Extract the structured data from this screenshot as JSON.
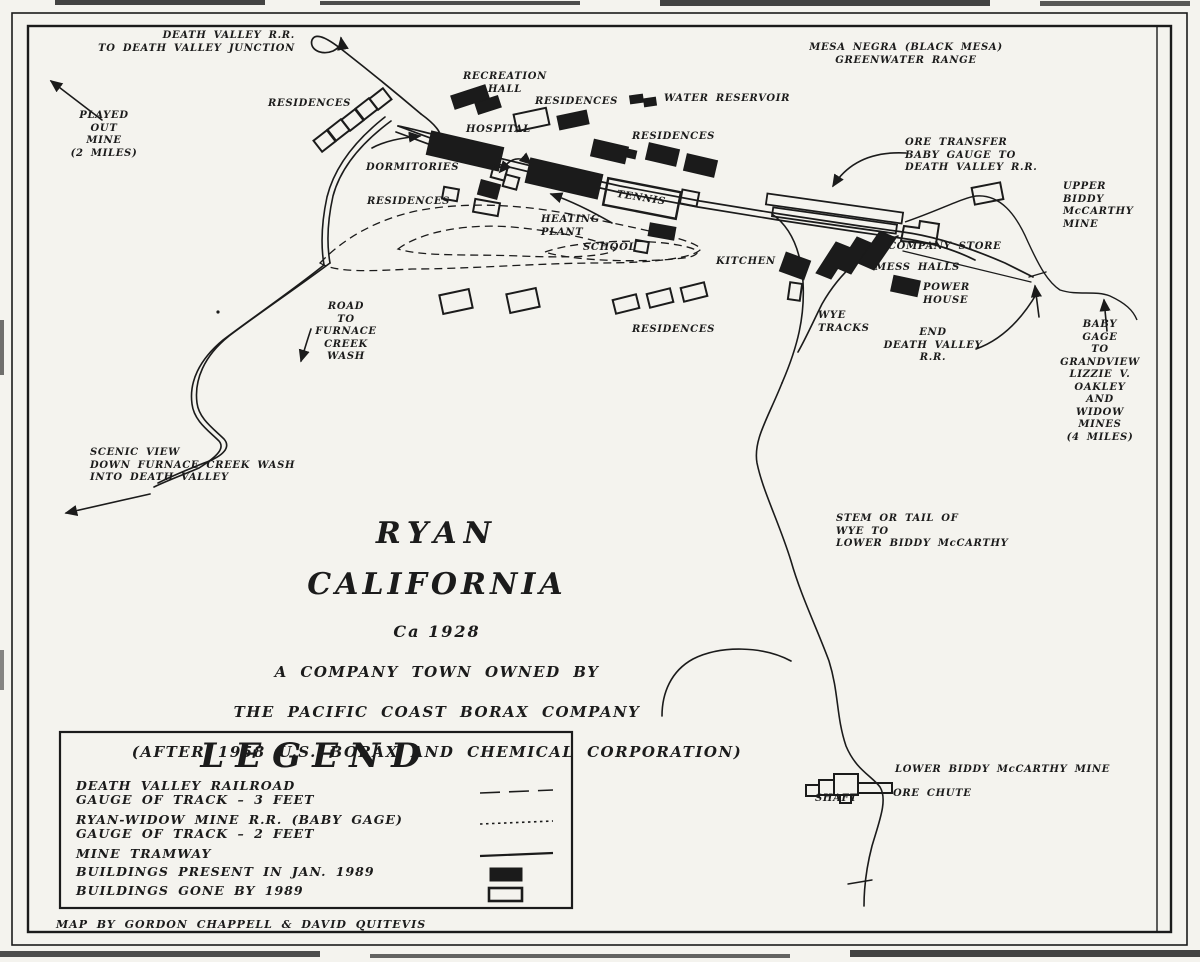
{
  "colors": {
    "paper": "#f4f3ee",
    "ink": "#1b1b1b"
  },
  "title": {
    "l1": "RYAN",
    "l2": "CALIFORNIA",
    "l3": "Ca 1928",
    "l4": "A COMPANY TOWN OWNED BY",
    "l5": "THE PACIFIC COAST BORAX COMPANY",
    "l6": "(AFTER 1958 U.S. BORAX AND CHEMICAL CORPORATION)"
  },
  "labels": {
    "dv_rr_junction": "DEATH VALLEY R.R.\nTO DEATH VALLEY JUNCTION",
    "played_out_mine": "PLAYED\nOUT\nMINE\n(2 MILES)",
    "mesa_negra": "MESA NEGRA (BLACK MESA)\nGREENWATER RANGE",
    "residences_nw": "RESIDENCES",
    "recreation_hall": "RECREATION\nHALL",
    "residences_c1": "RESIDENCES",
    "water_reservoir": "WATER RESERVOIR",
    "hospital": "HOSPITAL",
    "residences_c2": "RESIDENCES",
    "dormitories": "DORMITORIES",
    "ore_transfer": "ORE TRANSFER\nBABY GAUGE TO\nDEATH VALLEY R.R.",
    "upper_biddy": "UPPER\nBIDDY\nMcCARTHY\nMINE",
    "residences_w": "RESIDENCES",
    "heating_plant": "HEATING\nPLANT",
    "tennis": "TENNIS",
    "school": "SCHOOL",
    "company_store": "COMPANY STORE",
    "kitchen": "KITCHEN",
    "mess_halls": "MESS HALLS",
    "power_house": "POWER\nHOUSE",
    "wye_tracks": "WYE\nTRACKS",
    "road_furnace": "ROAD\nTO\nFURNACE\nCREEK\nWASH",
    "residences_s": "RESIDENCES",
    "end_dvrr": "END\nDEATH VALLEY\nR.R.",
    "baby_gage_grandview": "BABY\nGAGE\nTO\nGRANDVIEW\nLIZZIE V. OAKLEY\nAND\nWIDOW\nMINES\n(4 MILES)",
    "scenic_view": "SCENIC VIEW\nDOWN FURNACE CREEK WASH\nINTO DEATH VALLEY",
    "stem_tail": "STEM OR TAIL OF\nWYE TO\nLOWER BIDDY McCARTHY",
    "lower_biddy_mine": "LOWER BIDDY McCARTHY MINE",
    "shaft": "SHAFT",
    "ore_chute": "ORE CHUTE"
  },
  "legend": {
    "title": "LEGEND",
    "items": [
      {
        "label": "DEATH VALLEY RAILROAD\nGAUGE OF TRACK – 3 FEET",
        "symbol": "dashed-line"
      },
      {
        "label": "RYAN-WIDOW MINE R.R. (BABY GAGE)\nGAUGE OF TRACK – 2 FEET",
        "symbol": "dotted-line"
      },
      {
        "label": "MINE TRAMWAY",
        "symbol": "solid-line"
      },
      {
        "label": "BUILDINGS PRESENT IN JAN. 1989",
        "symbol": "filled-rect"
      },
      {
        "label": "BUILDINGS GONE BY 1989",
        "symbol": "open-rect"
      }
    ]
  },
  "credit": "MAP BY GORDON CHAPPELL & DAVID QUITEVIS"
}
